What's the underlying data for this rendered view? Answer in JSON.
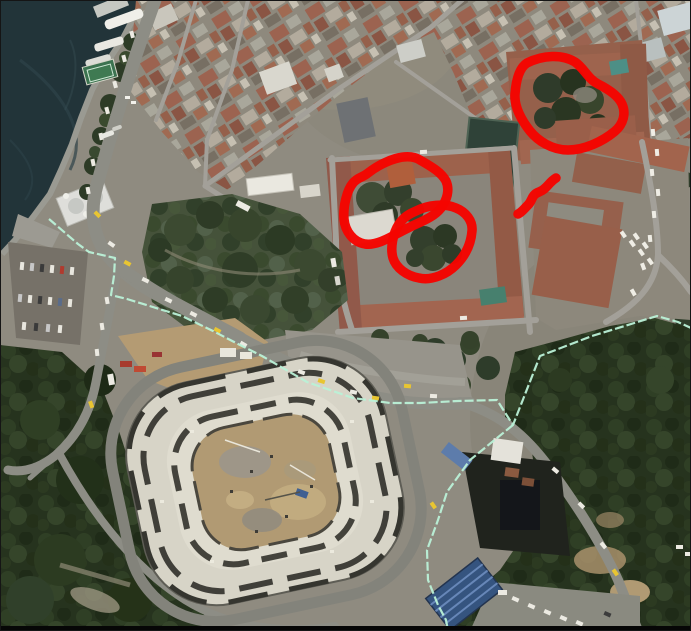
{
  "scene": {
    "width": 691,
    "height": 631,
    "kind": "satellite-aerial-photo"
  },
  "palette": {
    "water": "#223439",
    "land": "#8f8b80",
    "forest": "#26331e",
    "park": "#45523a",
    "roof_red": "#9a5f4a",
    "road_gray": "#8d8d85",
    "stadium_deck": "#d7d4c7",
    "stadium_dirt": "#b19a73",
    "annotation_red": "#f50400",
    "boundary_mint": "#baf1d7"
  },
  "annotations": {
    "red_loops": [
      {
        "name": "red-loop-northeast-courtyard",
        "path": "M527,63 C543,55 562,54 575,62 C584,68 588,79 598,84 C606,88 618,95 622,104 C626,113 624,124 614,132 C603,141 585,150 568,150 C552,150 538,141 530,131 C522,121 514,107 515,94 C516,81 519,68 527,63 Z"
      },
      {
        "name": "red-loop-center-left-block",
        "path": "M368,173 C385,160 407,152 420,160 C432,167 441,172 446,181 C450,190 447,200 441,208 C433,218 420,222 408,228 C395,234 379,246 365,244 C353,242 345,231 344,219 C343,206 347,190 353,183 C358,177 362,178 368,173 Z"
      },
      {
        "name": "red-loop-center-right-block",
        "path": "M416,211 C428,205 444,203 456,208 C466,212 473,221 472,231 C471,243 466,255 456,265 C447,274 432,281 419,278 C407,276 396,268 393,258 C390,248 393,233 399,224 C404,217 409,214 416,211 Z"
      }
    ],
    "red_mark": {
      "name": "red-squiggle-mark",
      "path": "M556,178 C549,182 547,189 539,192 C531,195 533,200 528,205 C523,210 522,212 518,214"
    },
    "boundary": {
      "name": "mint-boundary-line",
      "main": [
        [
          49,
          219
        ],
        [
          78,
          244
        ],
        [
          89,
          252
        ],
        [
          115,
          258
        ],
        [
          114,
          276
        ],
        [
          111,
          295
        ],
        [
          127,
          299
        ],
        [
          182,
          316
        ],
        [
          213,
          331
        ],
        [
          240,
          345
        ],
        [
          262,
          356
        ],
        [
          307,
          382
        ],
        [
          353,
          398
        ],
        [
          390,
          403
        ],
        [
          420,
          403
        ],
        [
          458,
          401
        ],
        [
          497,
          400
        ],
        [
          513,
          425
        ],
        [
          540,
          356
        ],
        [
          592,
          336
        ],
        [
          657,
          316
        ],
        [
          678,
          322
        ],
        [
          691,
          328
        ]
      ],
      "branch": [
        [
          513,
          425
        ],
        [
          470,
          460
        ],
        [
          447,
          492
        ],
        [
          438,
          520
        ],
        [
          427,
          550
        ],
        [
          428,
          580
        ],
        [
          438,
          605
        ],
        [
          446,
          620
        ],
        [
          448,
          631
        ]
      ]
    }
  }
}
